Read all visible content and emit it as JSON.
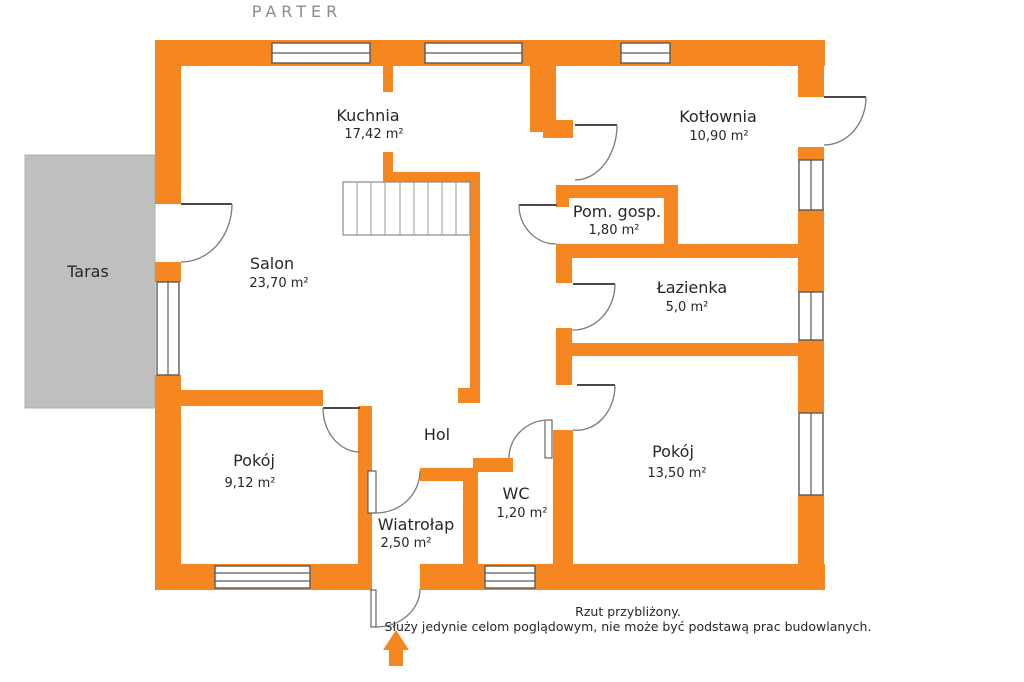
{
  "title": "PARTER",
  "colors": {
    "wall": "#F6861F",
    "terrace": "#BFBFBF",
    "terrace_border": "#AFAFAF",
    "label": "#26262E",
    "title": "#8C8C8C",
    "door_arc": "#7A7A7A",
    "door_leaf": "#4A4A4A"
  },
  "rooms": {
    "kuchnia": {
      "name": "Kuchnia",
      "area": "17,42 m²"
    },
    "kotlownia": {
      "name": "Kotłownia",
      "area": "10,90 m²"
    },
    "pom_gosp": {
      "name": "Pom. gosp.",
      "area": "1,80 m²"
    },
    "lazienka": {
      "name": "Łazienka",
      "area": "5,0 m²"
    },
    "salon": {
      "name": "Salon",
      "area": "23,70 m²"
    },
    "taras": {
      "name": "Taras"
    },
    "pokoj_maly": {
      "name": "Pokój",
      "area": "9,12 m²"
    },
    "hol": {
      "name": "Hol"
    },
    "wc": {
      "name": "WC",
      "area": "1,20 m²"
    },
    "wiatrolap": {
      "name": "Wiatrołap",
      "area": "2,50 m²"
    },
    "pokoj_duzy": {
      "name": "Pokój",
      "area": "13,50 m²"
    }
  },
  "disclaimer": {
    "line1": "Rzut przybliżony.",
    "line2": "Służy jedynie celom poglądowym, nie może być podstawą prac budowlanych."
  }
}
